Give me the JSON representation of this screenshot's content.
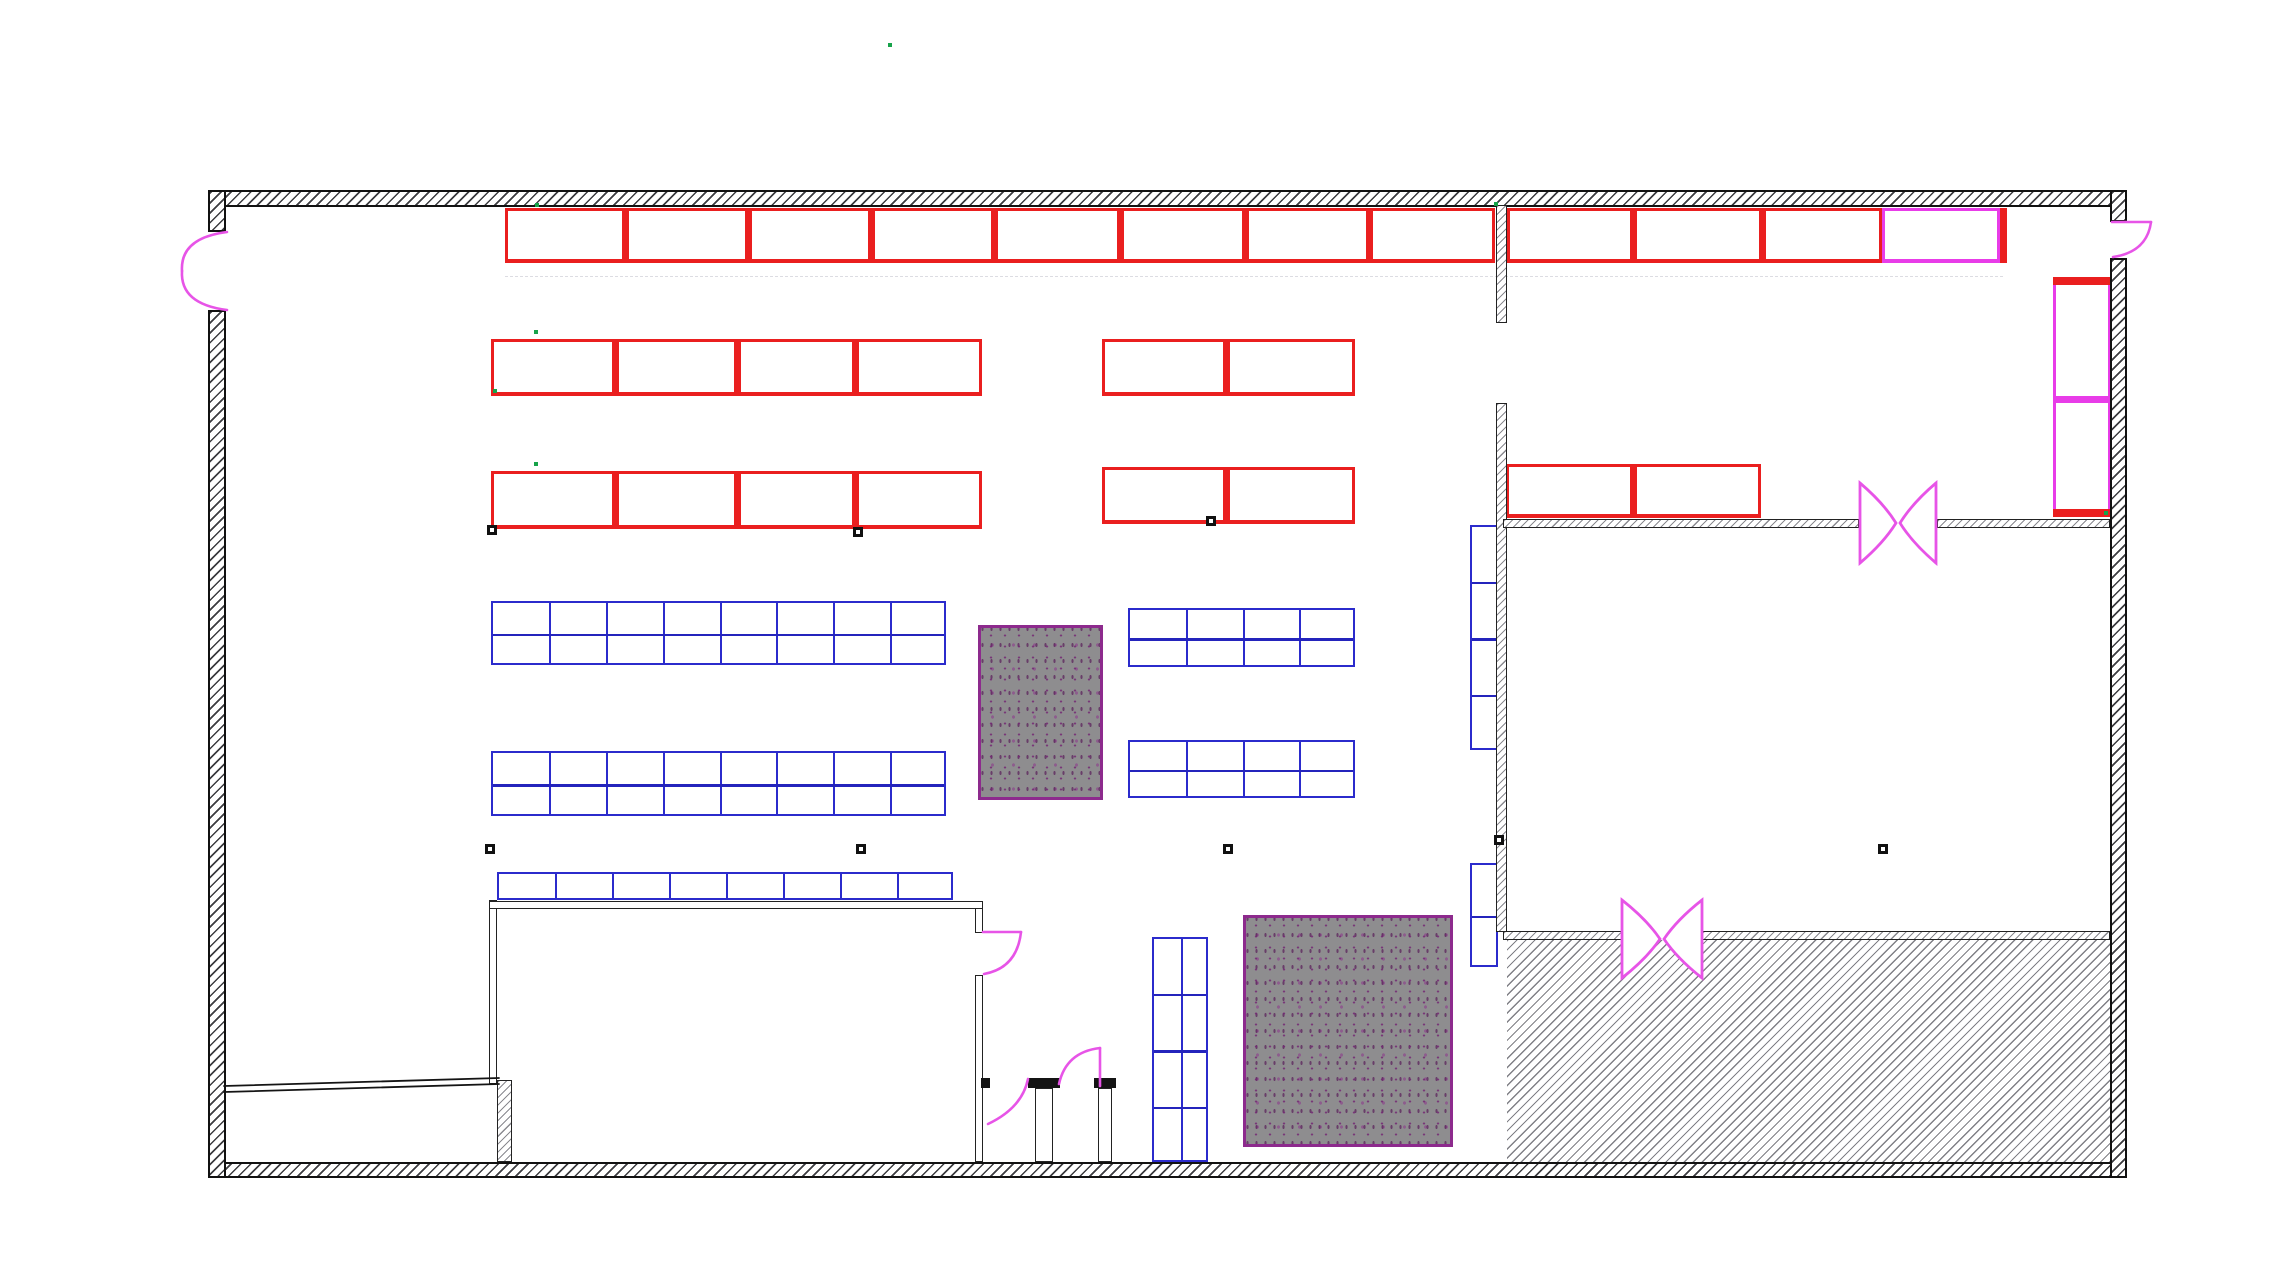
{
  "canvas": {
    "width": 2270,
    "height": 1288,
    "background": "#ffffff"
  },
  "colors": {
    "red": "#ea1f1f",
    "magenta": "#e83ce8",
    "blue": "#2b2bcc",
    "purple": "#8d2a8d",
    "door_pink": "#e754e7",
    "wall": "#141414",
    "green": "#17a34a",
    "mat_gray": "#8e8d8f"
  },
  "outer_walls": [
    {
      "name": "wall-top",
      "x": 208,
      "y": 190,
      "w": 1919,
      "h": 17
    },
    {
      "name": "wall-bottom",
      "x": 208,
      "y": 1162,
      "w": 1919,
      "h": 16
    },
    {
      "name": "wall-left-above-door",
      "x": 208,
      "y": 190,
      "w": 18,
      "h": 42
    },
    {
      "name": "wall-left-below-door",
      "x": 208,
      "y": 310,
      "w": 18,
      "h": 868
    },
    {
      "name": "wall-right-above-door",
      "x": 2110,
      "y": 190,
      "w": 17,
      "h": 32
    },
    {
      "name": "wall-right-below-door",
      "x": 2110,
      "y": 258,
      "w": 17,
      "h": 920
    }
  ],
  "interior_walls": [
    {
      "name": "partition-vertical-upper",
      "x": 1496,
      "y": 205,
      "w": 11,
      "h": 118
    },
    {
      "name": "partition-vertical-lower",
      "x": 1496,
      "y": 403,
      "w": 11,
      "h": 529
    },
    {
      "name": "partition-h1-left",
      "x": 1503,
      "y": 519,
      "w": 356,
      "h": 9
    },
    {
      "name": "partition-h1-right",
      "x": 1937,
      "y": 519,
      "w": 173,
      "h": 9
    },
    {
      "name": "partition-h2-left",
      "x": 1503,
      "y": 931,
      "w": 119,
      "h": 9
    },
    {
      "name": "partition-h2-right",
      "x": 1702,
      "y": 931,
      "w": 408,
      "h": 9
    },
    {
      "name": "smallroom-right-wall",
      "x": 497,
      "y": 1080,
      "w": 15,
      "h": 82
    }
  ],
  "plain_walls": [
    {
      "name": "office-wall-left",
      "x": 489,
      "y": 900,
      "w": 8,
      "h": 184
    },
    {
      "name": "office-wall-top",
      "x": 489,
      "y": 901,
      "w": 494,
      "h": 8
    },
    {
      "name": "office-wall-right-upper",
      "x": 975,
      "y": 908,
      "w": 8,
      "h": 25
    },
    {
      "name": "office-wall-right-lower",
      "x": 975,
      "y": 975,
      "w": 8,
      "h": 187
    },
    {
      "name": "vestibule-post-left",
      "x": 1035,
      "y": 1088,
      "w": 18,
      "h": 74
    },
    {
      "name": "vestibule-post-right",
      "x": 1098,
      "y": 1088,
      "w": 14,
      "h": 74
    }
  ],
  "caps": [
    {
      "name": "vestibule-cap-left",
      "x": 1028,
      "y": 1078,
      "w": 32,
      "h": 10
    },
    {
      "name": "vestibule-cap-right",
      "x": 1094,
      "y": 1078,
      "w": 22,
      "h": 10
    },
    {
      "name": "office-wall-cap",
      "x": 981,
      "y": 1078,
      "w": 9,
      "h": 10
    }
  ],
  "racks": [
    {
      "name": "rack-row1-left",
      "x": 505,
      "y": 208,
      "w": 990,
      "h": 55,
      "color": "red",
      "dividers": [
        626,
        749,
        872,
        995,
        1121,
        1246,
        1370
      ]
    },
    {
      "name": "rack-row1-right",
      "x": 1507,
      "y": 208,
      "w": 375,
      "h": 55,
      "color": "red",
      "dividers": [
        1634,
        1763
      ]
    },
    {
      "name": "rack-row1-end-bay",
      "x": 1882,
      "y": 208,
      "w": 118,
      "h": 55,
      "color": "magenta",
      "dividers": []
    },
    {
      "name": "rack-row2-left",
      "x": 491,
      "y": 339,
      "w": 491,
      "h": 57,
      "color": "red",
      "dividers": [
        616,
        738,
        856
      ]
    },
    {
      "name": "rack-row2-right",
      "x": 1102,
      "y": 339,
      "w": 253,
      "h": 57,
      "color": "red",
      "dividers": [
        1227
      ]
    },
    {
      "name": "rack-row3-left",
      "x": 491,
      "y": 471,
      "w": 491,
      "h": 58,
      "color": "red",
      "dividers": [
        616,
        738,
        856
      ]
    },
    {
      "name": "rack-row3-right",
      "x": 1102,
      "y": 467,
      "w": 253,
      "h": 57,
      "color": "red",
      "dividers": [
        1227
      ]
    },
    {
      "name": "rack-row3-far-right",
      "x": 1506,
      "y": 464,
      "w": 255,
      "h": 54,
      "color": "red",
      "dividers": [
        1634
      ]
    }
  ],
  "solid_bars": [
    {
      "name": "rack-row1-end-cap",
      "x": 2000,
      "y": 208,
      "w": 7,
      "h": 55,
      "color": "red"
    }
  ],
  "magenta_rack": {
    "name": "rack-magenta-vertical",
    "x": 2053,
    "y": 277,
    "w": 58,
    "h": 240,
    "parts": [
      {
        "y": 277,
        "h": 8,
        "color": "red"
      },
      {
        "y": 396,
        "h": 7,
        "color": "magenta"
      },
      {
        "y": 509,
        "h": 8,
        "color": "red"
      }
    ]
  },
  "grids": [
    {
      "name": "blue-grid-row1-left",
      "x": 491,
      "y": 601,
      "w": 455,
      "h": 64,
      "cols": 8,
      "rows": 2
    },
    {
      "name": "blue-grid-row2-left",
      "x": 491,
      "y": 751,
      "w": 455,
      "h": 65,
      "cols": 8,
      "rows": 2
    },
    {
      "name": "blue-grid-row1-right",
      "x": 1128,
      "y": 608,
      "w": 227,
      "h": 59,
      "cols": 4,
      "rows": 2
    },
    {
      "name": "blue-grid-row2-right",
      "x": 1128,
      "y": 740,
      "w": 227,
      "h": 58,
      "cols": 4,
      "rows": 2
    },
    {
      "name": "blue-grid-half-row",
      "x": 497,
      "y": 872,
      "w": 456,
      "h": 28,
      "cols": 8,
      "rows": 1
    },
    {
      "name": "blue-strip-upper",
      "x": 1470,
      "y": 525,
      "w": 28,
      "h": 225,
      "cols": 1,
      "rows": 4
    },
    {
      "name": "blue-strip-lower",
      "x": 1470,
      "y": 863,
      "w": 28,
      "h": 104,
      "cols": 1,
      "rows": 2
    },
    {
      "name": "blue-grid-center-vertical",
      "x": 1152,
      "y": 937,
      "w": 56,
      "h": 225,
      "cols": 2,
      "rows": 4
    }
  ],
  "mats": [
    {
      "name": "gray-mat-small",
      "x": 978,
      "y": 625,
      "w": 125,
      "h": 175
    },
    {
      "name": "gray-mat-large",
      "x": 1243,
      "y": 915,
      "w": 210,
      "h": 232
    }
  ],
  "hatched_area": {
    "name": "hatched-floor-area",
    "x": 1507,
    "y": 940,
    "w": 603,
    "h": 222
  },
  "bowtie_doors": [
    {
      "name": "double-action-door-1",
      "cx": 1898,
      "cy": 523,
      "hw": 38,
      "hh": 40
    },
    {
      "name": "double-action-door-2",
      "cx": 1662,
      "cy": 939,
      "hw": 40,
      "hh": 39
    }
  ],
  "door_paths": [
    {
      "name": "entry-door-left-upper-leaf",
      "d": "M 227 232 Q 180 238 182 271"
    },
    {
      "name": "entry-door-left-lower-leaf",
      "d": "M 227 310 Q 180 304 182 271"
    },
    {
      "name": "door-top-right-leaf",
      "d": "M 2112 222 L 2151 222"
    },
    {
      "name": "door-top-right-arc",
      "d": "M 2151 222 Q 2147 252 2113 257"
    },
    {
      "name": "office-door-leaf",
      "d": "M 983 932 L 1021 932"
    },
    {
      "name": "office-door-arc",
      "d": "M 1021 932 Q 1017 968 984 974"
    },
    {
      "name": "vestibule-door-left-arc",
      "d": "M 988 1124 Q 1022 1108 1028 1079"
    },
    {
      "name": "vestibule-door-right-leaf",
      "d": "M 1100 1048 L 1100 1086"
    },
    {
      "name": "vestibule-door-right-arc",
      "d": "M 1100 1048 Q 1066 1052 1059 1084"
    }
  ],
  "sloped_wall_lines": [
    {
      "name": "smallroom-top-wall-outer",
      "d": "M 224 1086 L 499 1078"
    },
    {
      "name": "smallroom-top-wall-inner",
      "d": "M 224 1092 L 499 1084"
    }
  ],
  "nodes": [
    [
      492,
      530
    ],
    [
      858,
      532
    ],
    [
      1211,
      521
    ],
    [
      490,
      849
    ],
    [
      861,
      849
    ],
    [
      1228,
      849
    ],
    [
      1883,
      849
    ],
    [
      1499,
      840
    ]
  ],
  "green_marks": [
    [
      890,
      45
    ],
    [
      537,
      205
    ],
    [
      536,
      332
    ],
    [
      495,
      391
    ],
    [
      536,
      464
    ],
    [
      1496,
      204
    ],
    [
      2106,
      513
    ]
  ],
  "dashed_line": {
    "name": "column-grid-line",
    "x": 505,
    "y": 276,
    "w": 1498
  }
}
